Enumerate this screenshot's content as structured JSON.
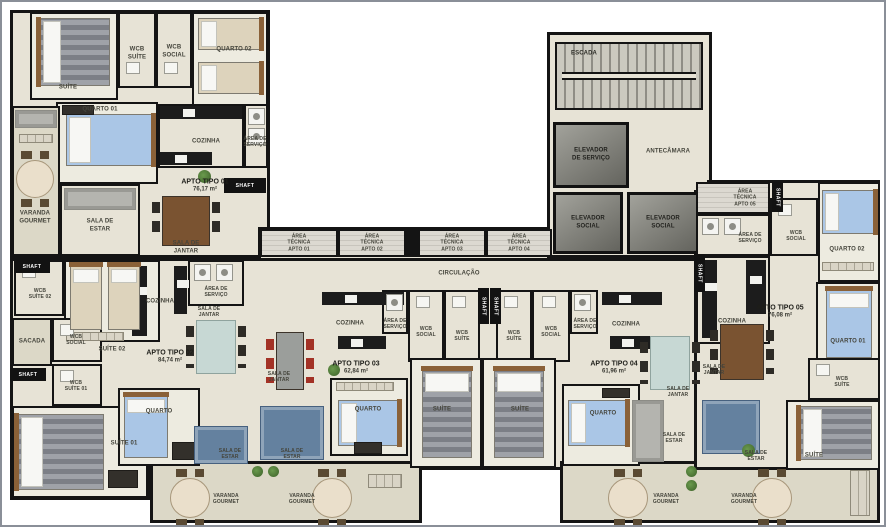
{
  "colors": {
    "wall": "#141414",
    "floor": "#e7e3d6",
    "floor_light": "#edebe0",
    "balcony": "#dcd8c7",
    "tech_hatch": "#cbc8c0",
    "elevator": "#8e8e87",
    "bed_blue": "#aac6e6",
    "sofa_blue": "#64819f",
    "table_wood": "#7a5331",
    "table_teal": "#c7d8d4",
    "chair_red": "#a33226"
  },
  "shaft_label": "SHAFT",
  "core": {
    "escada": "ESCADA",
    "elevador_servico": "ELEVADOR\nDE SERVIÇO",
    "antecamara": "ANTECÂMARA",
    "elevador_social_1": "ELEVADOR\nSOCIAL",
    "elevador_social_2": "ELEVADOR\nSOCIAL",
    "circulacao": "CIRCULAÇÃO"
  },
  "tech_areas": {
    "a1": "ÁREA\nTÉCNICA\nAPTO 01",
    "a2": "ÁREA\nTÉCNICA\nAPTO 02",
    "a3": "ÁREA\nTÉCNICA\nAPTO 03",
    "a4": "ÁREA\nTÉCNICA\nAPTO 04"
  },
  "apartments": {
    "a1": {
      "name": "APTO TIPO 01",
      "area": "76,17 m²",
      "rooms": {
        "suite": "SUÍTE",
        "wcb_suite": "WCB\nSUÍTE",
        "wcb_social": "WCB\nSOCIAL",
        "quarto02": "QUARTO 02",
        "quarto01": "QUARTO 01",
        "cozinha": "COZINHA",
        "area_servico": "ÁREA DE\nSERVIÇO",
        "varanda": "VARANDA\nGOURMET",
        "sala_estar": "SALA DE\nESTAR",
        "sala_jantar": "SALA DE\nJANTAR"
      }
    },
    "a2": {
      "name": "APTO TIPO 02",
      "area": "84,74 m²",
      "rooms": {
        "wcb_suite02": "WCB\nSUÍTE 02",
        "suite02": "SUÍTE 02",
        "sacada": "SACADA",
        "wcb_social": "WCB\nSOCIAL",
        "wcb_suite01": "WCB\nSUÍTE 01",
        "suite01": "SUÍTE 01",
        "quarto": "QUARTO",
        "cozinha": "COZINHA",
        "area_servico": "ÁREA DE\nSERVIÇO",
        "sala_jantar": "SALA DE\nJANTAR",
        "sala_estar": "SALA DE\nESTAR",
        "varanda": "VARANDA\nGOURMET"
      }
    },
    "a3": {
      "name": "APTO TIPO 03",
      "area": "62,84 m²",
      "rooms": {
        "sala_jantar": "SALA DE\nJANTAR",
        "cozinha": "COZINHA",
        "area_servico": "ÁREA DE\nSERVIÇO",
        "wcb_social": "WCB\nSOCIAL",
        "wcb_suite": "WCB\nSUÍTE",
        "quarto": "QUARTO",
        "suite": "SUÍTE",
        "sala_estar": "SALA DE\nESTAR",
        "varanda": "VARANDA\nGOURMET"
      }
    },
    "a4": {
      "name": "APTO TIPO 04",
      "area": "61,96 m²",
      "rooms": {
        "wcb_suite": "WCB\nSUÍTE",
        "wcb_social": "WCB\nSOCIAL",
        "area_servico": "ÁREA DE\nSERVIÇO",
        "cozinha": "COZINHA",
        "suite": "SUÍTE",
        "quarto": "QUARTO",
        "sala_jantar": "SALA DE\nJANTAR",
        "sala_estar": "SALA DE\nESTAR",
        "varanda": "VARANDA\nGOURMET"
      }
    },
    "a5": {
      "name": "APTO TIPO 05",
      "area": "76,08 m²",
      "rooms": {
        "area_tecnica": "ÁREA\nTÉCNICA\nAPTO 05",
        "area_servico": "ÁREA DE\nSERVIÇO",
        "wcb_social": "WCB\nSOCIAL",
        "quarto02": "QUARTO 02",
        "cozinha": "COZINHA",
        "quarto01": "QUARTO 01",
        "wcb_suite": "WCB\nSUÍTE",
        "sala_jantar": "SALA DE\nJANTAR",
        "sala_estar": "SALA DE\nESTAR",
        "suite": "SUÍTE",
        "varanda": "VARANDA\nGOURMET"
      }
    }
  }
}
